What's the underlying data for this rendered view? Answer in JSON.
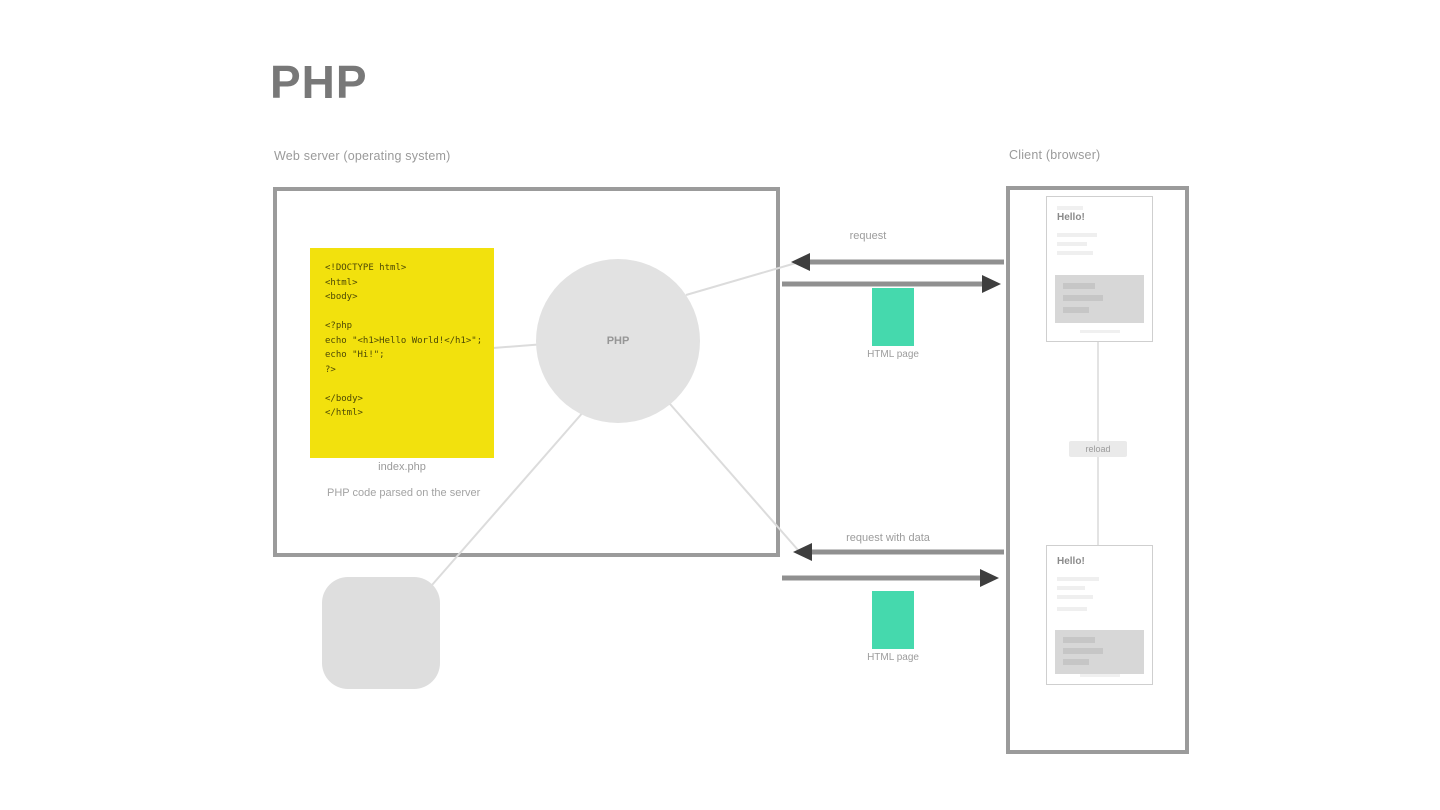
{
  "page": {
    "title": "PHP"
  },
  "server": {
    "label": "Web server (operating system)",
    "code": {
      "lines": [
        "<!DOCTYPE html>",
        "<html>",
        "<body>",
        "",
        "<?php",
        "echo \"<h1>Hello World!</h1>\";",
        "echo \"Hi!\";",
        "?>",
        "",
        "</body>",
        "</html>"
      ],
      "filename": "index.php",
      "note": "PHP code parsed on the server"
    },
    "interpreter_label": "PHP"
  },
  "exchange": {
    "request_top_label": "request",
    "payload_top_label": "HTML page",
    "request_bottom_label": "request with data",
    "payload_bottom_label": "HTML page"
  },
  "client": {
    "label": "Client (browser)",
    "page1_title": "Hello!",
    "page2_title": "Hello!",
    "between_label": "reload"
  },
  "colors": {
    "accent_yellow": "#f2e10d",
    "accent_green": "#45d9ad",
    "frame_border": "#9b9b9b"
  }
}
